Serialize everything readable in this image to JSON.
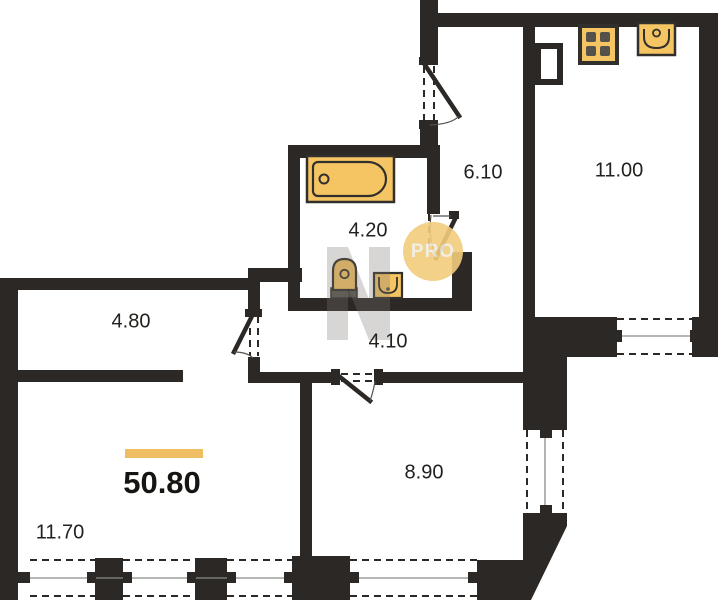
{
  "plan": {
    "watermark_badge": "PRO",
    "total": {
      "area": "50.80"
    },
    "rooms": [
      {
        "id": "hallway",
        "area": "6.10"
      },
      {
        "id": "kitchen",
        "area": "11.00"
      },
      {
        "id": "bathroom",
        "area": "4.20"
      },
      {
        "id": "corridor",
        "area": "4.10"
      },
      {
        "id": "hall",
        "area": "4.80"
      },
      {
        "id": "bedroom",
        "area": "8.90"
      },
      {
        "id": "living-room",
        "area": "11.70"
      }
    ],
    "fixtures": [
      "bathtub-icon",
      "toilet-icon",
      "washbasin-icon",
      "stove-icon",
      "kitchen-sink-icon"
    ],
    "colors": {
      "bg": "#ffffff",
      "wall": "#2b2826",
      "fixture_fill": "#f5c463",
      "fixture_stroke": "#32302c",
      "fixture_dark": "#55524c",
      "accent_bar": "#efbe63",
      "badge_bg": "#f3cd7c",
      "badge_text": "#f1ece1",
      "watermark_gray": "#7d766f",
      "label_text": "#23211e"
    }
  }
}
